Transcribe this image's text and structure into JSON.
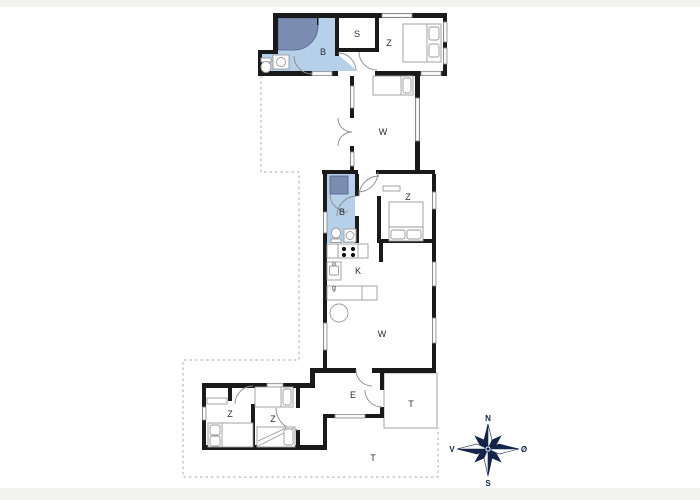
{
  "floor_plan": {
    "rooms": [
      {
        "id": "bathroom-top",
        "label": "B"
      },
      {
        "id": "storage-top",
        "label": "S"
      },
      {
        "id": "bedroom-top",
        "label": "Z"
      },
      {
        "id": "living-upper",
        "label": "W"
      },
      {
        "id": "bathroom-middle",
        "label": "B"
      },
      {
        "id": "bedroom-middle",
        "label": "Z"
      },
      {
        "id": "kitchen",
        "label": "K"
      },
      {
        "id": "kitchen-note",
        "label": "g"
      },
      {
        "id": "living-lower",
        "label": "W"
      },
      {
        "id": "bedroom-bottom-left",
        "label": "Z"
      },
      {
        "id": "bedroom-bottom-right",
        "label": "Z"
      },
      {
        "id": "entrance",
        "label": "E"
      },
      {
        "id": "terrace",
        "label": "T"
      },
      {
        "id": "terrace-south",
        "label": "T"
      }
    ],
    "compass": {
      "north": "N",
      "south": "S",
      "west": "V",
      "east": "Ø"
    },
    "colors": {
      "wall": "#1a1a1a",
      "bathroom_fill": "#b7d0ea",
      "shower_fill": "#7b8db1",
      "window_fill": "#ececec",
      "window_stroke": "#8f8f8f",
      "furniture_stroke": "#9a9a9a",
      "door_arc": "#8a8a8a",
      "dashed_boundary": "#a9a9a9",
      "terrace_outline": "#b5b5b5",
      "compass": "#16244a",
      "page_band": "#f2f2ef"
    }
  }
}
